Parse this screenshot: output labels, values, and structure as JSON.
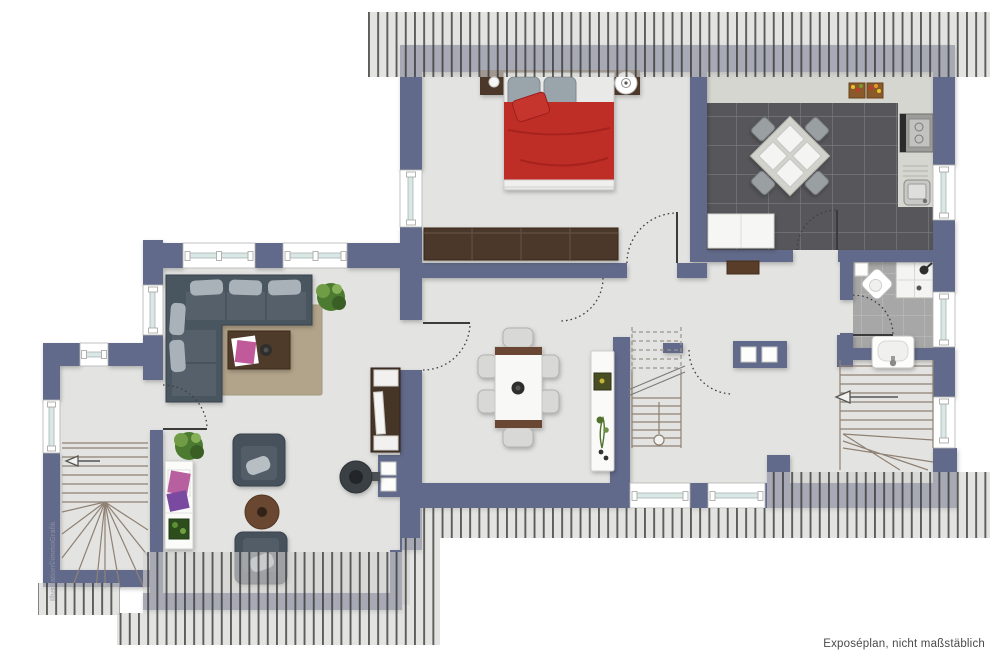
{
  "credits": {
    "illustration": "Illustration©immoGrafik",
    "disclaimer": "Exposéplan, nicht maßstäblich"
  },
  "palette": {
    "wall": "#626b8b",
    "floor": "#e3e3e1",
    "hatch_bg": "#d2d2ce",
    "hatch_line": "#2e2e2e",
    "kitchen_tile": "#57575b",
    "kitchen_grout": "#7d7d82",
    "counter": "#d6d6d0",
    "bath_tile": "#a7a7a7",
    "bath_grout": "#c2c2c0",
    "shower_white": "#f4f4f2",
    "glass": "#d9e7e5",
    "window_frame": "#ffffff",
    "wood_dark": "#4c3729",
    "wood_mid": "#6a4730",
    "bed_red": "#bf2d28",
    "bed_red_dark": "#931d18",
    "pillow": "#9aa4ab",
    "sofa": "#4a545e",
    "sofa_seat": "#57616b",
    "cushion": "#a9b2b8",
    "rug": "#b2a48a",
    "stair_line": "#8f8173",
    "plant_green": "#4c7a31",
    "plant_light": "#6f9c44",
    "text_dark": "#4a4a4a",
    "text_light": "#9094a0"
  },
  "areas": [
    "bedroom",
    "kitchen",
    "bathroom",
    "hallway",
    "living-room",
    "study",
    "entry",
    "staircase-center",
    "staircase-right",
    "staircase-left",
    "roof-overhang"
  ],
  "furnishings": {
    "bedroom": [
      "double-bed-red",
      "headboard-with-nightstands",
      "alarm-clock",
      "wardrobe"
    ],
    "kitchen": [
      "square-dining-table-4-chairs",
      "stove",
      "sink-counter",
      "fruit-crates",
      "white-cabinet"
    ],
    "bathroom": [
      "toilet",
      "shower",
      "washbasin",
      "shaft"
    ],
    "living_room": [
      "corner-sofa",
      "rug",
      "coffee-table",
      "tv-sideboard",
      "potted-plant"
    ],
    "study": [
      "armchair",
      "armchair",
      "round-side-table",
      "shelf",
      "potted-plant",
      "wood-stove",
      "chimney"
    ],
    "hallway": [
      "dining-table-6-chairs",
      "sideboard",
      "bench",
      "chimney-block"
    ]
  }
}
